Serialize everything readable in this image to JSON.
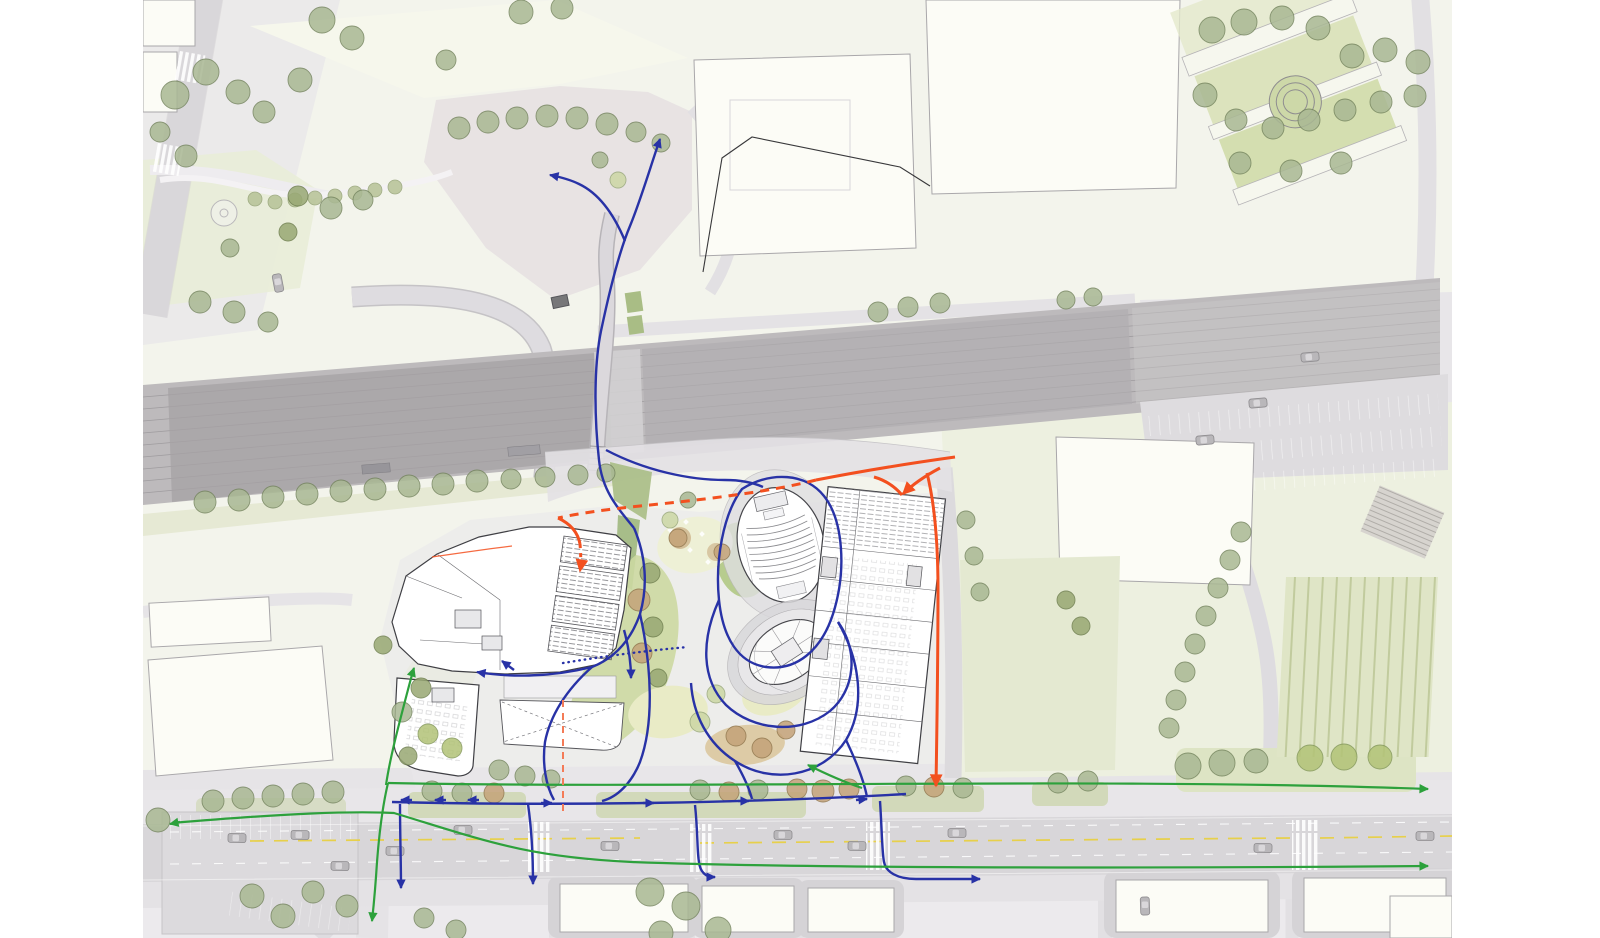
{
  "meta": {
    "canvas": {
      "width": 1600,
      "height": 938
    },
    "plan_area": {
      "left": 143,
      "right": 1452
    }
  },
  "palette": {
    "paper": "#ffffff",
    "plan-base": "#f3f4ec",
    "urban-gray": "#e9e7ea",
    "road-gray": "#dbd9dc",
    "rail-gray": "#bdbabc",
    "building-white": "#fcfcf6",
    "lawn-green": "#ccd8a2",
    "verge-green": "#dde4c4",
    "road-yellow": "#e7d04b",
    "flow-pedestrian": "#2832a6",
    "flow-cycle": "#2da13c",
    "flow-vehicle": "#f3501f",
    "flow-axis": "#f47b57"
  },
  "flows": {
    "modes": {
      "pedestrian": {
        "label": "pedestrian-route-blue"
      },
      "cycle": {
        "label": "cycle-route-green"
      },
      "vehicle": {
        "label": "vehicle-route-orange"
      },
      "axis": {
        "label": "site-axis-dashed"
      }
    },
    "routes": [
      {
        "id": "bridge-north",
        "mode": "pedestrian",
        "d": "M 634,528 C 615,505 602,489 599,460 C 595,424 593,370 601,331 C 609,293 619,252 630,226 C 641,199 650,168 660,139",
        "arrow": "end"
      },
      {
        "id": "bridge-branch-west",
        "mode": "pedestrian",
        "d": "M 625,241 C 613,212 598,193 579,184 C 571,180 560,177 550,175",
        "arrow": "end"
      },
      {
        "id": "to-left-entrance",
        "mode": "pedestrian",
        "d": "M 634,528 C 646,556 648,586 640,614 C 630,643 612,659 592,667 C 548,678 506,677 477,672",
        "arrow": "end"
      },
      {
        "id": "lobby-arrow",
        "mode": "pedestrian",
        "d": "M 514,670 L 502,661",
        "arrow": "end"
      },
      {
        "id": "auditorium-loop",
        "mode": "pedestrian",
        "d": "M 742,489 C 771,471 806,473 824,496 C 843,520 847,570 833,614 C 821,651 796,671 766,667 C 739,663 723,639 719,600 C 715,561 723,514 742,489 Z"
      },
      {
        "id": "forecourt-link",
        "mode": "pedestrian",
        "d": "M 606,450 C 646,471 690,480 725,480 C 740,480 752,482 763,487"
      },
      {
        "id": "tower-loop",
        "mode": "pedestrian",
        "d": "M 719,600 C 701,640 701,679 726,705 C 753,731 800,735 830,711 C 855,690 859,651 838,622"
      },
      {
        "id": "tower-loop-south",
        "mode": "pedestrian",
        "d": "M 838,622 C 860,660 866,706 846,740 C 822,777 771,785 735,761 C 707,743 693,714 691,683"
      },
      {
        "id": "promenade",
        "mode": "pedestrian",
        "d": "M 392,802 C 560,806 750,803 906,794"
      },
      {
        "id": "prom-arrow-l1",
        "mode": "pedestrian",
        "d": "M 412,800 L 401,800",
        "arrow": "end"
      },
      {
        "id": "prom-arrow-l2",
        "mode": "pedestrian",
        "d": "M 446,800 L 435,800",
        "arrow": "end"
      },
      {
        "id": "prom-arrow-l3",
        "mode": "pedestrian",
        "d": "M 479,800 L 468,800",
        "arrow": "end"
      },
      {
        "id": "prom-arrow-r1",
        "mode": "pedestrian",
        "d": "M 541,803 L 552,803",
        "arrow": "end"
      },
      {
        "id": "prom-arrow-r2",
        "mode": "pedestrian",
        "d": "M 643,803 L 654,803",
        "arrow": "end"
      },
      {
        "id": "prom-arrow-r3",
        "mode": "pedestrian",
        "d": "M 738,801 L 749,801",
        "arrow": "end"
      },
      {
        "id": "prom-arrow-r4",
        "mode": "pedestrian",
        "d": "M 856,800 L 867,799",
        "arrow": "end"
      },
      {
        "id": "hub-southwest",
        "mode": "pedestrian",
        "d": "M 592,667 C 566,690 550,716 545,742 C 542,764 546,786 554,800"
      },
      {
        "id": "hub-south",
        "mode": "pedestrian",
        "d": "M 640,614 C 652,668 654,724 640,762 C 632,782 618,797 602,801"
      },
      {
        "id": "tower-promenade",
        "mode": "pedestrian",
        "d": "M 735,761 C 743,775 749,787 752,799"
      },
      {
        "id": "east-promenade",
        "mode": "pedestrian",
        "d": "M 846,740 C 856,761 864,781 867,797"
      },
      {
        "id": "crossing-a",
        "mode": "pedestrian",
        "d": "M 400,804 C 400,834 401,862 401,888",
        "arrow": "end"
      },
      {
        "id": "crossing-b",
        "mode": "pedestrian",
        "d": "M 528,804 C 532,832 533,858 533,884",
        "arrow": "end"
      },
      {
        "id": "crossing-c",
        "mode": "pedestrian",
        "d": "M 695,805 C 698,833 697,852 699,862 C 700,872 706,877 713,877 L 715,877",
        "arrow": "end"
      },
      {
        "id": "crossing-d",
        "mode": "pedestrian",
        "d": "M 880,801 C 882,831 882,852 884,862 C 886,872 897,879 916,879 L 980,879",
        "arrow": "end"
      },
      {
        "id": "desire-line-dotted",
        "mode": "pedestrian",
        "d": "M 563,663 C 600,657 642,651 688,647",
        "dash": "dotted"
      },
      {
        "id": "mid-arrow-down",
        "mode": "pedestrian",
        "d": "M 624,630 C 629,648 631,663 631,678",
        "arrow": "end"
      },
      {
        "id": "blvd-north",
        "mode": "cycle",
        "d": "M 388,783 C 700,789 1100,777 1428,789",
        "arrow": "end"
      },
      {
        "id": "blvd-south",
        "mode": "cycle",
        "d": "M 172,823 C 290,813 352,811 394,813 C 486,841 526,857 632,862 C 820,869 1200,868 1428,866",
        "arrow": "end"
      },
      {
        "id": "blvd-south-west-arrow",
        "mode": "cycle",
        "d": "M 180,822 L 170,824",
        "arrow": "end"
      },
      {
        "id": "south-branch",
        "mode": "cycle",
        "d": "M 388,783 C 383,804 379,836 377,862 C 375,894 373,912 372,921",
        "arrow": "end"
      },
      {
        "id": "site-branch",
        "mode": "cycle",
        "d": "M 386,785 C 390,758 398,728 405,701 C 409,686 412,674 414,668",
        "arrow": "end"
      },
      {
        "id": "inner-branch",
        "mode": "cycle",
        "d": "M 862,788 C 847,783 828,775 808,765",
        "arrow": "end"
      },
      {
        "id": "main-approach",
        "mode": "vehicle",
        "d": "M 955,457 C 912,463 862,471 816,480"
      },
      {
        "id": "main-dashed",
        "mode": "vehicle",
        "d": "M 816,480 C 770,492 700,500 640,506 C 610,509 580,513 558,518",
        "dash": "dashed"
      },
      {
        "id": "y-curl-left",
        "mode": "vehicle",
        "d": "M 874,477 C 888,481 896,488 902,495"
      },
      {
        "id": "y-arrow-building",
        "mode": "vehicle",
        "d": "M 940,468 C 923,477 911,486 903,494",
        "arrow": "end"
      },
      {
        "id": "east-road-down",
        "mode": "vehicle",
        "d": "M 927,473 C 935,505 938,545 938,590 C 938,658 937,724 936,786",
        "arrow": "end"
      },
      {
        "id": "dropoff-curve",
        "mode": "vehicle",
        "d": "M 558,518 C 571,524 578,533 580,544"
      },
      {
        "id": "dropoff-arrow",
        "mode": "vehicle",
        "d": "M 580,544 C 581,556 581,565 580,571",
        "dash": "dash-short",
        "arrow": "end"
      },
      {
        "id": "thin-tail",
        "mode": "vehicle",
        "d": "M 432,557 C 460,553 487,549 512,546",
        "w": 1.2,
        "opacity": 0.85
      },
      {
        "id": "axis-dashed",
        "mode": "axis",
        "d": "M 563,700 L 563,815",
        "dash": "dash-axis",
        "w": 2
      }
    ]
  },
  "trees": [
    [
      175,
      95,
      14
    ],
    [
      206,
      72,
      13
    ],
    [
      238,
      92,
      12
    ],
    [
      264,
      112,
      11
    ],
    [
      300,
      80,
      12
    ],
    [
      322,
      20,
      13
    ],
    [
      352,
      38,
      12
    ],
    [
      160,
      132,
      10
    ],
    [
      186,
      156,
      11
    ],
    [
      298,
      196,
      10,
      "olive"
    ],
    [
      331,
      208,
      11
    ],
    [
      363,
      200,
      10
    ],
    [
      288,
      232,
      9,
      "olive"
    ],
    [
      230,
      248,
      9
    ],
    [
      200,
      302,
      11
    ],
    [
      234,
      312,
      11
    ],
    [
      268,
      322,
      10
    ],
    [
      459,
      128,
      11
    ],
    [
      488,
      122,
      11
    ],
    [
      517,
      118,
      11
    ],
    [
      547,
      116,
      11
    ],
    [
      577,
      118,
      11
    ],
    [
      607,
      124,
      11
    ],
    [
      636,
      132,
      10
    ],
    [
      661,
      143,
      9
    ],
    [
      446,
      60,
      10
    ],
    [
      521,
      12,
      12
    ],
    [
      562,
      8,
      11
    ],
    [
      618,
      180,
      8,
      "pale"
    ],
    [
      600,
      160,
      8
    ],
    [
      1212,
      30,
      13
    ],
    [
      1244,
      22,
      13
    ],
    [
      1282,
      18,
      12
    ],
    [
      1318,
      28,
      12
    ],
    [
      1352,
      56,
      12
    ],
    [
      1385,
      50,
      12
    ],
    [
      1418,
      62,
      12
    ],
    [
      1205,
      95,
      12
    ],
    [
      1236,
      120,
      11
    ],
    [
      1273,
      128,
      11
    ],
    [
      1309,
      120,
      11
    ],
    [
      1345,
      110,
      11
    ],
    [
      1381,
      102,
      11
    ],
    [
      1415,
      96,
      11
    ],
    [
      1240,
      163,
      11
    ],
    [
      1291,
      171,
      11
    ],
    [
      1341,
      163,
      11
    ],
    [
      878,
      312,
      10
    ],
    [
      908,
      307,
      10
    ],
    [
      940,
      303,
      10
    ],
    [
      1066,
      300,
      9
    ],
    [
      1093,
      297,
      9
    ],
    [
      1241,
      532,
      10
    ],
    [
      1230,
      560,
      10
    ],
    [
      1218,
      588,
      10
    ],
    [
      1206,
      616,
      10
    ],
    [
      1195,
      644,
      10
    ],
    [
      1185,
      672,
      10
    ],
    [
      1176,
      700,
      10
    ],
    [
      1169,
      728,
      10
    ],
    [
      205,
      502,
      11
    ],
    [
      239,
      500,
      11
    ],
    [
      273,
      497,
      11
    ],
    [
      307,
      494,
      11
    ],
    [
      341,
      491,
      11
    ],
    [
      375,
      489,
      11
    ],
    [
      409,
      486,
      11
    ],
    [
      443,
      484,
      11
    ],
    [
      477,
      481,
      11
    ],
    [
      511,
      479,
      10
    ],
    [
      545,
      477,
      10
    ],
    [
      578,
      475,
      10
    ],
    [
      606,
      473,
      9
    ],
    [
      383,
      645,
      9,
      "olive"
    ],
    [
      421,
      688,
      10,
      "olive"
    ],
    [
      402,
      712,
      10
    ],
    [
      428,
      734,
      10,
      "bright"
    ],
    [
      452,
      748,
      10,
      "bright"
    ],
    [
      408,
      756,
      9,
      "olive"
    ],
    [
      650,
      573,
      10,
      "olive"
    ],
    [
      639,
      600,
      11,
      "brown"
    ],
    [
      653,
      627,
      10,
      "olive"
    ],
    [
      642,
      653,
      10,
      "brown"
    ],
    [
      658,
      678,
      9,
      "olive"
    ],
    [
      670,
      520,
      8,
      "pale"
    ],
    [
      688,
      500,
      8
    ],
    [
      678,
      538,
      9,
      "brown"
    ],
    [
      722,
      552,
      8,
      "brown"
    ],
    [
      700,
      722,
      10,
      "pale"
    ],
    [
      736,
      736,
      10,
      "brown"
    ],
    [
      762,
      748,
      10,
      "brown"
    ],
    [
      786,
      730,
      9,
      "brown"
    ],
    [
      716,
      694,
      9,
      "pale"
    ],
    [
      499,
      770,
      10
    ],
    [
      525,
      776,
      10
    ],
    [
      551,
      779,
      9
    ],
    [
      432,
      791,
      10
    ],
    [
      462,
      793,
      10
    ],
    [
      494,
      793,
      10,
      "brown"
    ],
    [
      700,
      790,
      10
    ],
    [
      729,
      792,
      10,
      "brown"
    ],
    [
      758,
      790,
      10
    ],
    [
      797,
      789,
      10,
      "brown"
    ],
    [
      823,
      791,
      11,
      "brown"
    ],
    [
      849,
      789,
      10,
      "brown"
    ],
    [
      906,
      786,
      10
    ],
    [
      934,
      787,
      10,
      "brown"
    ],
    [
      963,
      788,
      10
    ],
    [
      1058,
      783,
      10
    ],
    [
      1088,
      781,
      10
    ],
    [
      1188,
      766,
      13
    ],
    [
      1222,
      763,
      13
    ],
    [
      1256,
      761,
      12
    ],
    [
      1310,
      758,
      13,
      "bright"
    ],
    [
      1344,
      757,
      13,
      "bright"
    ],
    [
      1380,
      757,
      12,
      "bright"
    ],
    [
      213,
      801,
      11
    ],
    [
      243,
      798,
      11
    ],
    [
      273,
      796,
      11
    ],
    [
      303,
      794,
      11
    ],
    [
      333,
      792,
      11
    ],
    [
      158,
      820,
      12
    ],
    [
      252,
      896,
      12
    ],
    [
      283,
      916,
      12
    ],
    [
      313,
      892,
      11
    ],
    [
      347,
      906,
      11
    ],
    [
      650,
      892,
      14
    ],
    [
      686,
      906,
      14
    ],
    [
      718,
      930,
      13
    ],
    [
      661,
      933,
      12
    ],
    [
      424,
      918,
      10
    ],
    [
      456,
      930,
      10
    ],
    [
      966,
      520,
      9
    ],
    [
      974,
      556,
      9
    ],
    [
      980,
      592,
      9
    ],
    [
      1066,
      600,
      9,
      "olive"
    ],
    [
      1081,
      626,
      9,
      "olive"
    ]
  ],
  "cars": [
    [
      300,
      835,
      1
    ],
    [
      395,
      851,
      1
    ],
    [
      463,
      830,
      0
    ],
    [
      610,
      846,
      1
    ],
    [
      783,
      835,
      0
    ],
    [
      857,
      846,
      1
    ],
    [
      957,
      833,
      0
    ],
    [
      1263,
      848,
      1
    ],
    [
      1425,
      836,
      0
    ],
    [
      1205,
      440,
      -5
    ],
    [
      1258,
      403,
      -5
    ],
    [
      1310,
      357,
      -5
    ],
    [
      278,
      283,
      79
    ],
    [
      237,
      838,
      1
    ],
    [
      340,
      866,
      1
    ],
    [
      1145,
      906,
      88
    ]
  ]
}
